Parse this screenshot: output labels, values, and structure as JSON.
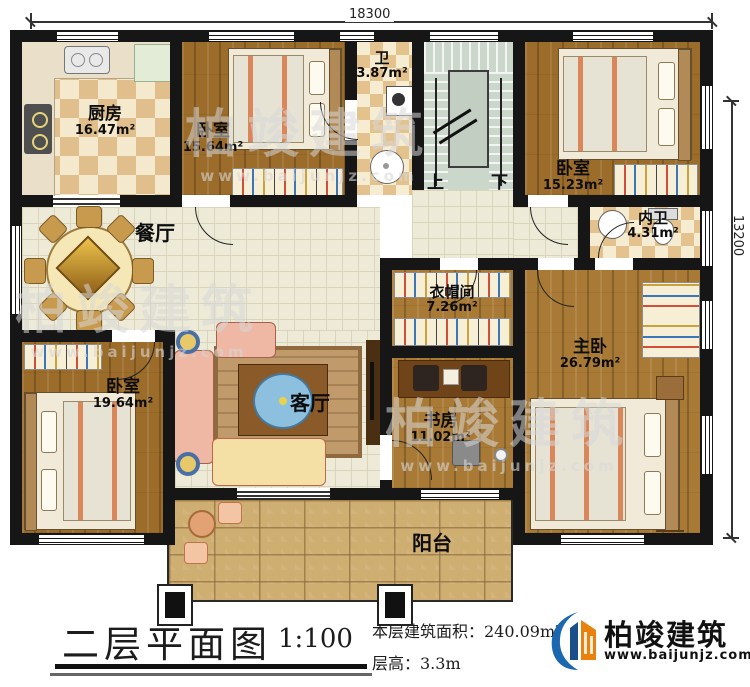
{
  "dimensions": {
    "width_label": "18300",
    "height_label": "13200"
  },
  "rooms": [
    {
      "id": "kitchen",
      "name": "厨房",
      "area": "16.47m²"
    },
    {
      "id": "bedroom-top",
      "name": "卧室",
      "area": "15.64m²"
    },
    {
      "id": "bathroom",
      "name": "卫",
      "area": "3.87m²"
    },
    {
      "id": "bedroom-topright",
      "name": "卧室",
      "area": "15.23m²"
    },
    {
      "id": "dining-room",
      "name": "餐厅",
      "area": ""
    },
    {
      "id": "ensuite-bath",
      "name": "内卫",
      "area": "4.31m²"
    },
    {
      "id": "cloakroom",
      "name": "衣帽间",
      "area": "7.26m²"
    },
    {
      "id": "master-bedroom",
      "name": "主卧",
      "area": "26.79m²"
    },
    {
      "id": "bedroom-left",
      "name": "卧室",
      "area": "19.64m²"
    },
    {
      "id": "living-room",
      "name": "客厅",
      "area": ""
    },
    {
      "id": "study",
      "name": "书房",
      "area": "11.02m²"
    },
    {
      "id": "balcony",
      "name": "阳台",
      "area": ""
    }
  ],
  "stairs": {
    "up": "上",
    "down": "下"
  },
  "footer": {
    "title": "二层平面图",
    "scale": "1:100",
    "area_line": "本层建筑面积：240.09m²",
    "height_line": "层高：3.3m"
  },
  "logo": {
    "name": "柏竣建筑",
    "url": "www.baijunjz.com"
  },
  "watermark": {
    "text": "柏竣建筑",
    "url": "www.baijunjz.com"
  }
}
